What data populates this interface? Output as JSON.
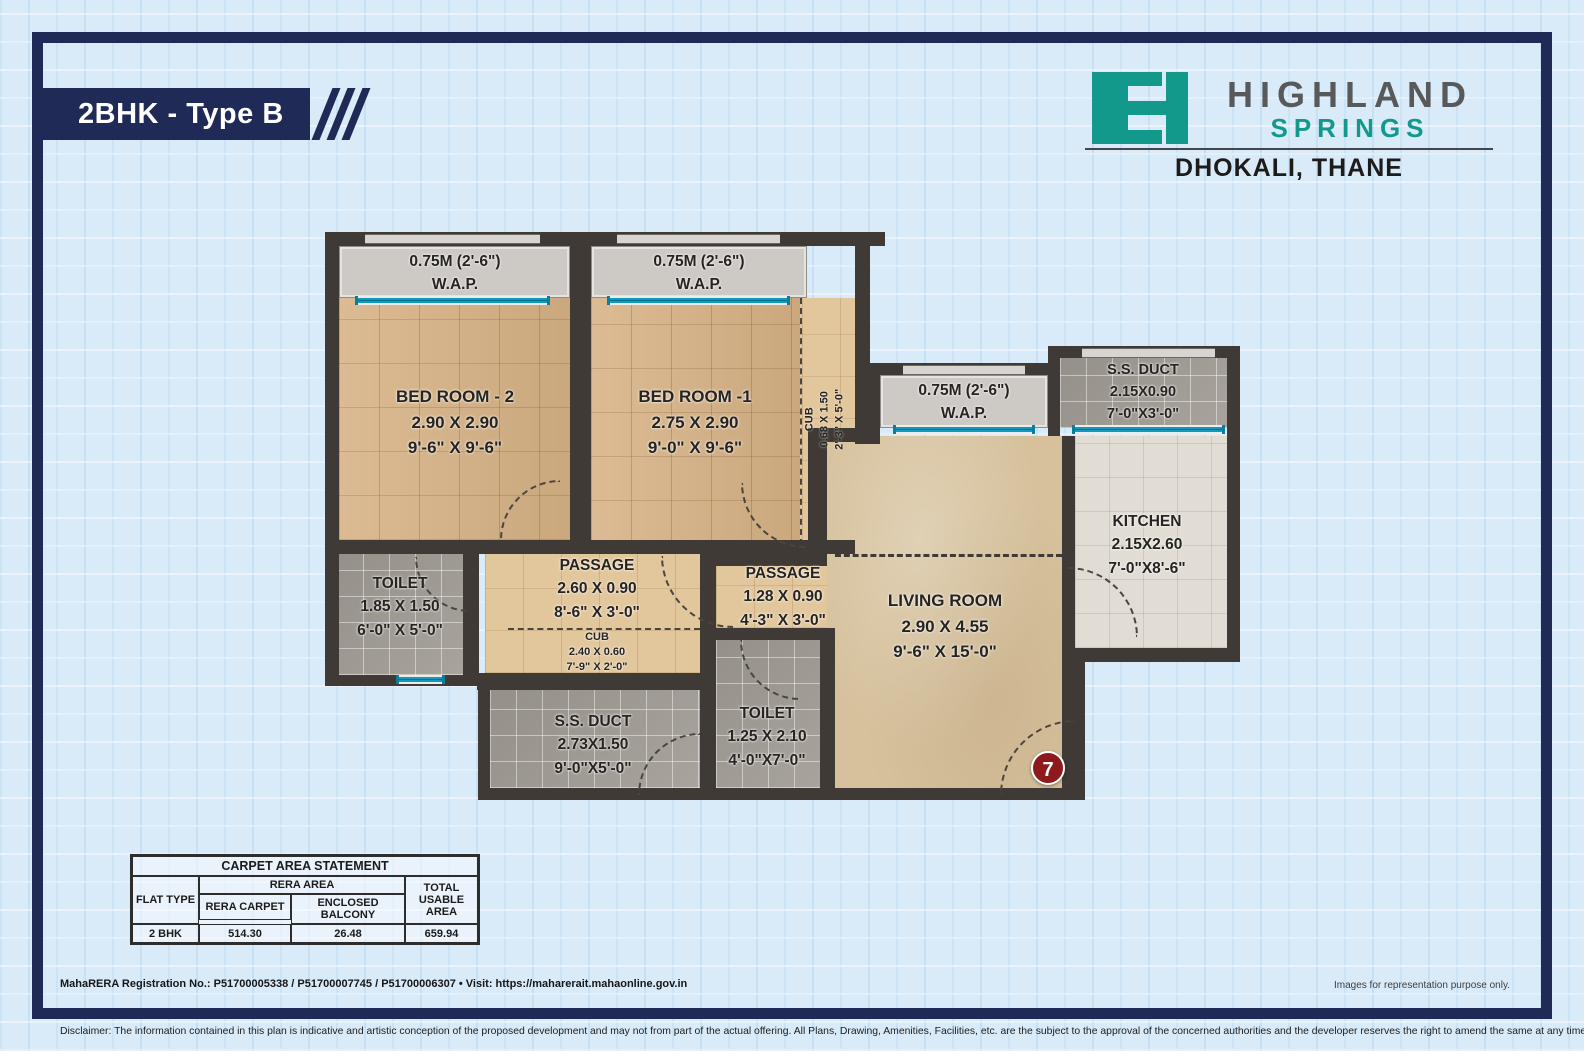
{
  "header": {
    "banner_title": "2BHK - Type B",
    "brand_top": "HIGHLAND",
    "brand_bottom": "SPRINGS",
    "location": "DHOKALI, THANE",
    "teal": "#13998b",
    "navy": "#1f2a56"
  },
  "plan": {
    "rooms": {
      "wap2": {
        "l1": "0.75M (2'-6\")",
        "l2": "W.A.P."
      },
      "wap1": {
        "l1": "0.75M (2'-6\")",
        "l2": "W.A.P."
      },
      "wap_lr": {
        "l1": "0.75M (2'-6\")",
        "l2": "W.A.P."
      },
      "bed2": {
        "name": "BED ROOM - 2",
        "m": "2.90 X 2.90",
        "ft": "9'-6\" X 9'-6\""
      },
      "bed1": {
        "name": "BED ROOM -1",
        "m": "2.75 X 2.90",
        "ft": "9'-0\" X 9'-6\""
      },
      "cub1": {
        "name": "CUB",
        "m": "0.68 X 1.50",
        "ft": "2'-3\" X 5'-0\""
      },
      "toilet1": {
        "name": "TOILET",
        "m": "1.85 X 1.50",
        "ft": "6'-0\" X 5'-0\""
      },
      "passage1": {
        "name": "PASSAGE",
        "m": "2.60 X 0.90",
        "ft": "8'-6\" X 3'-0\""
      },
      "cub2": {
        "name": "CUB",
        "m": "2.40 X 0.60",
        "ft": "7'-9\" X 2'-0\""
      },
      "passage2": {
        "name": "PASSAGE",
        "m": "1.28 X 0.90",
        "ft": "4'-3\" X 3'-0\""
      },
      "living": {
        "name": "LIVING ROOM",
        "m": "2.90 X 4.55",
        "ft": "9'-6\" X 15'-0\""
      },
      "kitchen": {
        "name": "KITCHEN",
        "m": "2.15X2.60",
        "ft": "7'-0\"X8'-6\""
      },
      "ssduct_top": {
        "name": "S.S. DUCT",
        "m": "2.15X0.90",
        "ft": "7'-0\"X3'-0\""
      },
      "ssduct_bottom": {
        "name": "S.S. DUCT",
        "m": "2.73X1.50",
        "ft": "9'-0\"X5'-0\""
      },
      "toilet2": {
        "name": "TOILET",
        "m": "1.25 X 2.10",
        "ft": "4'-0\"X7'-0\""
      }
    },
    "door_marker": "7"
  },
  "table": {
    "title": "CARPET AREA STATEMENT",
    "col_flat_type": "FLAT TYPE",
    "col_rera_area": "RERA AREA",
    "col_rera_carpet": "RERA CARPET",
    "col_enclosed_balcony": "ENCLOSED BALCONY",
    "col_total_usable": "TOTAL USABLE AREA",
    "rows": [
      {
        "flat_type": "2 BHK",
        "rera_carpet": "514.30",
        "enclosed_balcony": "26.48",
        "total_usable": "659.94"
      }
    ]
  },
  "footer": {
    "rera_line": "MahaRERA Registration No.:  P51700005338 / P51700007745 / P51700006307   •  Visit: https://maharerait.mahaonline.gov.in",
    "images_note": "Images for representation purpose only.",
    "disclaimer": "Disclaimer: The information contained in this plan is indicative and artistic conception of the proposed development and may not from part of the actual offering. All Plans, Drawing, Amenities, Facilities, etc. are the subject to the approval of the concerned authorities and the developer reserves the right to amend the same at any time without notice."
  }
}
